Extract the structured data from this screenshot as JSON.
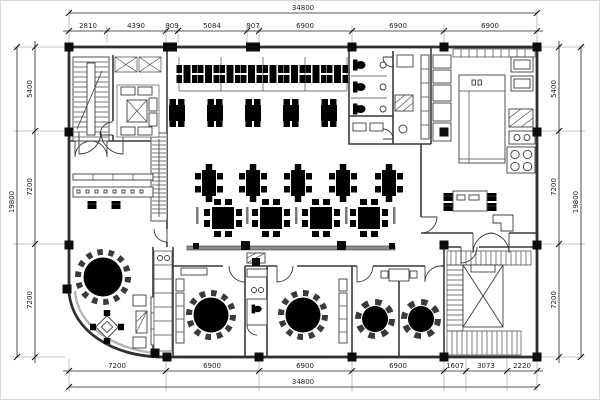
{
  "drawing_title": "floor-plan",
  "dims": {
    "top": {
      "total": "34800",
      "segments": [
        "2810",
        "4390",
        "909",
        "5084",
        "907",
        "6900",
        "6900",
        "6900"
      ]
    },
    "bottom": {
      "total": "34800",
      "segments": [
        "7200",
        "6900",
        "6900",
        "6900",
        "1607",
        "3073",
        "2220"
      ]
    },
    "left": {
      "total": "19800",
      "segments": [
        "5400",
        "7200",
        "7200"
      ]
    },
    "right": {
      "total": "19800",
      "segments": [
        "5400",
        "7200",
        "7200"
      ]
    }
  }
}
